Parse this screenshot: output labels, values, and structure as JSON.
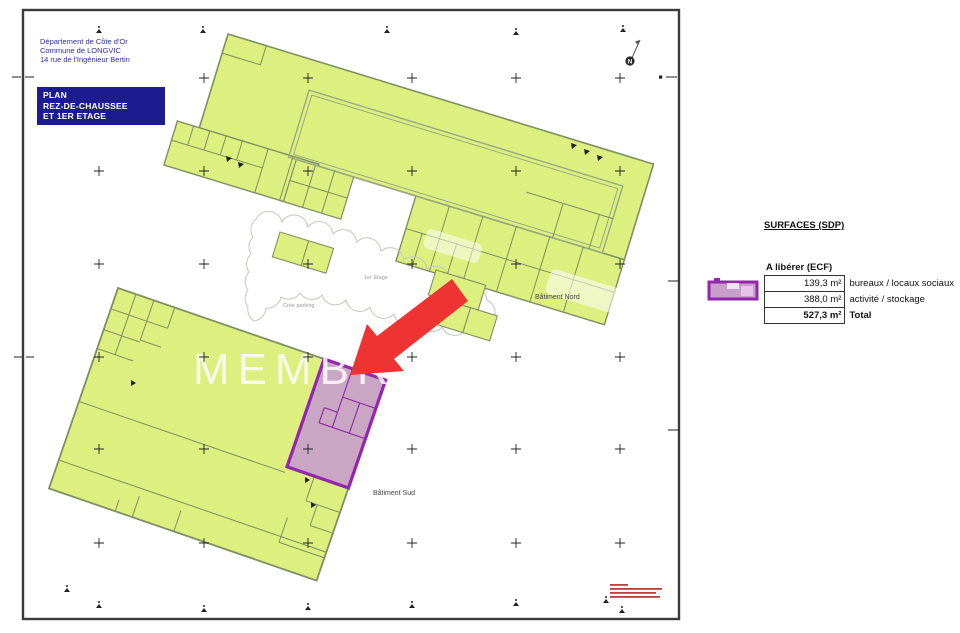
{
  "header": {
    "line1": "Département de Côte d'Or",
    "line2": "Commune de LONGVIC",
    "line3": "14 rue de l'Ingénieur Bertin"
  },
  "title_box": {
    "line1": "PLAN",
    "line2": "REZ-DE-CHAUSSEE",
    "line3": "ET 1ER ETAGE"
  },
  "plan": {
    "north_label": "N",
    "watermark": "MEMBRE IN",
    "building_north_label": "Bâtiment Nord",
    "building_south_label": "Bâtiment Sud",
    "first_floor_label": "1er Etage",
    "parking_label": "Crée parking",
    "colors": {
      "building_fill": "#dcef7f",
      "building_stroke": "#7f8f63",
      "highlight_fill": "#c79fc9",
      "highlight_stroke": "#9326ad",
      "arrow": "#ee3333",
      "title_box_bg": "#1c1c90",
      "header_text": "#2e2e9d",
      "cloud_stroke": "#c4c8bc"
    }
  },
  "legend": {
    "title": "SURFACES (SDP)",
    "subtitle": "A libérer (ECF)",
    "rows": [
      {
        "value": "139,3 m²",
        "label": "bureaux / locaux sociaux"
      },
      {
        "value": "388,0 m²",
        "label": "activité / stockage"
      },
      {
        "value": "527,3 m²",
        "label": "Total"
      }
    ]
  },
  "fine_print": {
    "line_widths": {
      "w0": "18",
      "w1": "52",
      "w2": "46",
      "w3": "50"
    }
  }
}
